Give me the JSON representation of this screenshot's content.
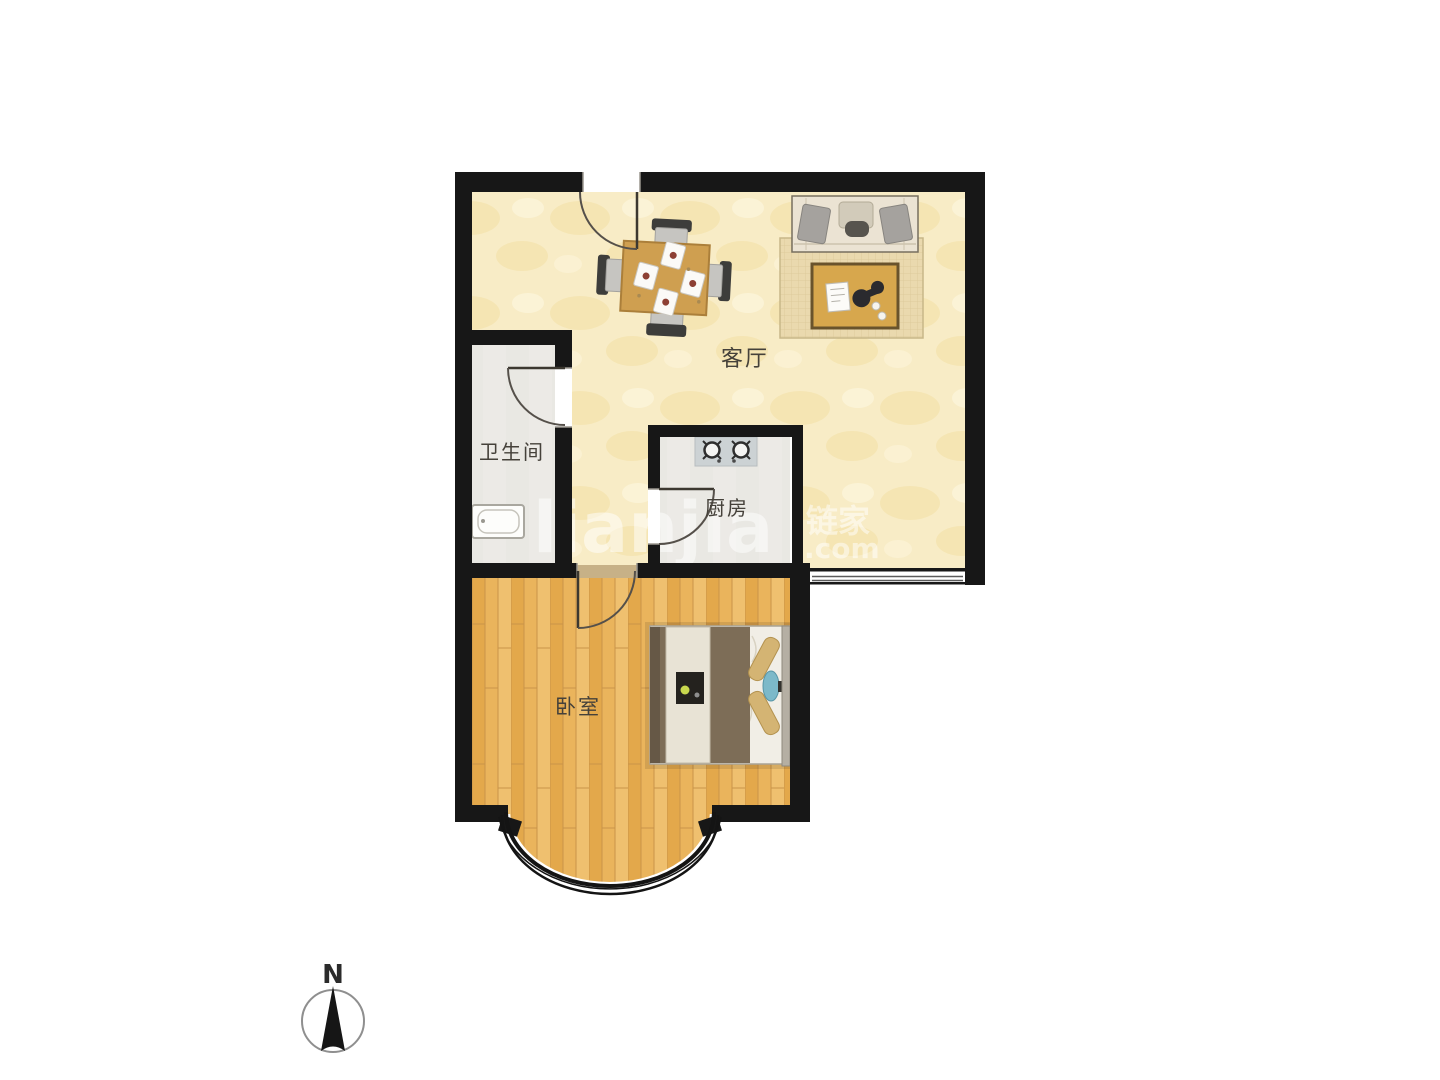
{
  "floor_plan": {
    "rooms": [
      {
        "id": "living-room",
        "label": "客厅"
      },
      {
        "id": "bathroom",
        "label": "卫生间"
      },
      {
        "id": "kitchen",
        "label": "厨房"
      },
      {
        "id": "bedroom",
        "label": "卧室"
      }
    ],
    "compass": {
      "label": "N"
    },
    "watermark": {
      "brand_latin": "lianjia",
      "brand_cn": "链家",
      "suffix": ".com"
    },
    "colors": {
      "background": "#ffffff",
      "wall": "#171717",
      "living_floor": "#f8ecc6",
      "bedroom_wood_floor": "#e9b359",
      "tile_floor": "#eceae6",
      "rug": "#ead9ae",
      "table_wood": "#cf9f50",
      "bed_duvet": "#7d6d57",
      "bed_pillow_tan": "#d4b473",
      "bed_cushion_blue": "#7cb9c9"
    }
  }
}
